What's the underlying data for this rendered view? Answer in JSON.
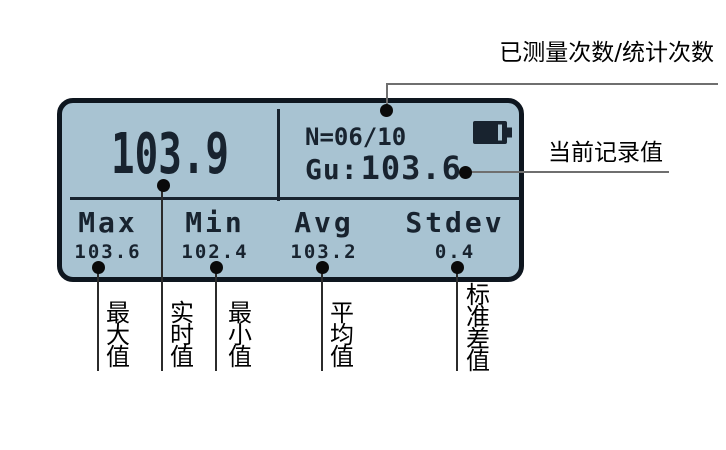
{
  "screen": {
    "main_value": "103.9",
    "counter": "N=06/10",
    "record_label": "Gu:",
    "record_value": "103.6",
    "battery_icon": "battery-icon",
    "stats": [
      {
        "label": "Max",
        "value": "103.6"
      },
      {
        "label": "Min",
        "value": "102.4"
      },
      {
        "label": "Avg",
        "value": "103.2"
      },
      {
        "label": "Stdev",
        "value": "0.4"
      }
    ],
    "colors": {
      "screen_bg": "#a8c3d2",
      "screen_border": "#0e161f",
      "screen_text": "#18232f"
    }
  },
  "annotations": {
    "top": "已测量次数/统计次数",
    "right": "当前记录值",
    "bottom_labels": [
      "最大值",
      "实时值",
      "最小值",
      "平均值",
      "标准差值"
    ]
  }
}
